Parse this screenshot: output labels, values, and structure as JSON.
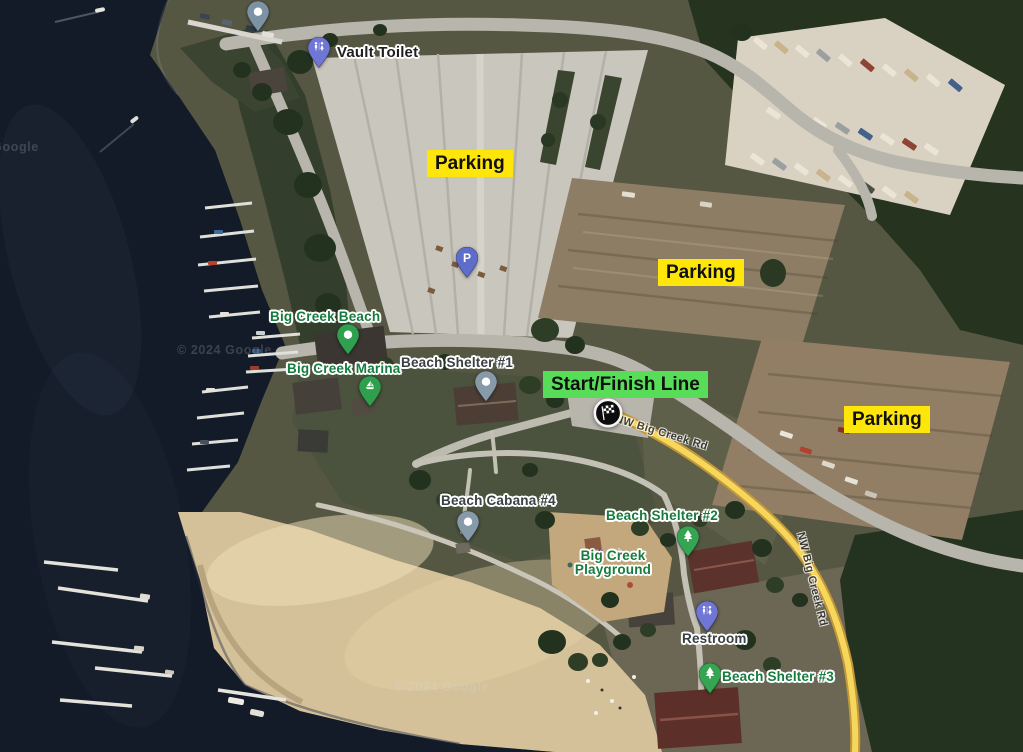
{
  "attribution": "© 2024 Google",
  "map": {
    "road_label": "NW Big Creek Rd",
    "road_highlight_color": "#f6d75b"
  },
  "annotations": {
    "parking_labels": [
      "Parking",
      "Parking",
      "Parking"
    ],
    "start_finish_label": "Start/Finish Line",
    "highlight_yellow": "#ffe60a",
    "highlight_green": "#57dd57",
    "start_marker_icon": "checkered-flag"
  },
  "pois": {
    "vault_toilet": {
      "label": "Vault Toilet",
      "pin": "restroom-pin"
    },
    "parking_p": {
      "label": "P",
      "pin": "parking-pin"
    },
    "big_creek_beach": {
      "label": "Big Creek Beach",
      "pin": "green-dot-pin"
    },
    "big_creek_marina": {
      "label": "Big Creek Marina",
      "pin": "marina-pin"
    },
    "beach_shelter_1": {
      "label": "Beach Shelter #1",
      "pin": "gray-dot-pin"
    },
    "beach_cabana_4": {
      "label": "Beach Cabana #4",
      "pin": "gray-dot-pin"
    },
    "beach_shelter_2": {
      "label": "Beach Shelter #2",
      "pin": "green-tree-pin"
    },
    "big_creek_playground": {
      "label": "Big Creek Playground",
      "pin": "none"
    },
    "restroom": {
      "label": "Restroom",
      "pin": "restroom-pin"
    },
    "beach_shelter_3": {
      "label": "Beach Shelter #3",
      "pin": "green-tree-pin"
    },
    "unnamed_dock_pin": {
      "label": "",
      "pin": "gray-dot-pin"
    }
  },
  "colors": {
    "poi_green": "#167c3d",
    "poi_gray": "#3b4043",
    "poi_black": "#1f1f1f",
    "water": "#141b28",
    "sand": "#d5c199",
    "pin_gray_blue": "#879aa8",
    "pin_green": "#2fa04f",
    "pin_indigo": "#6f76d6",
    "pin_parking_blue": "#5f6dca"
  }
}
